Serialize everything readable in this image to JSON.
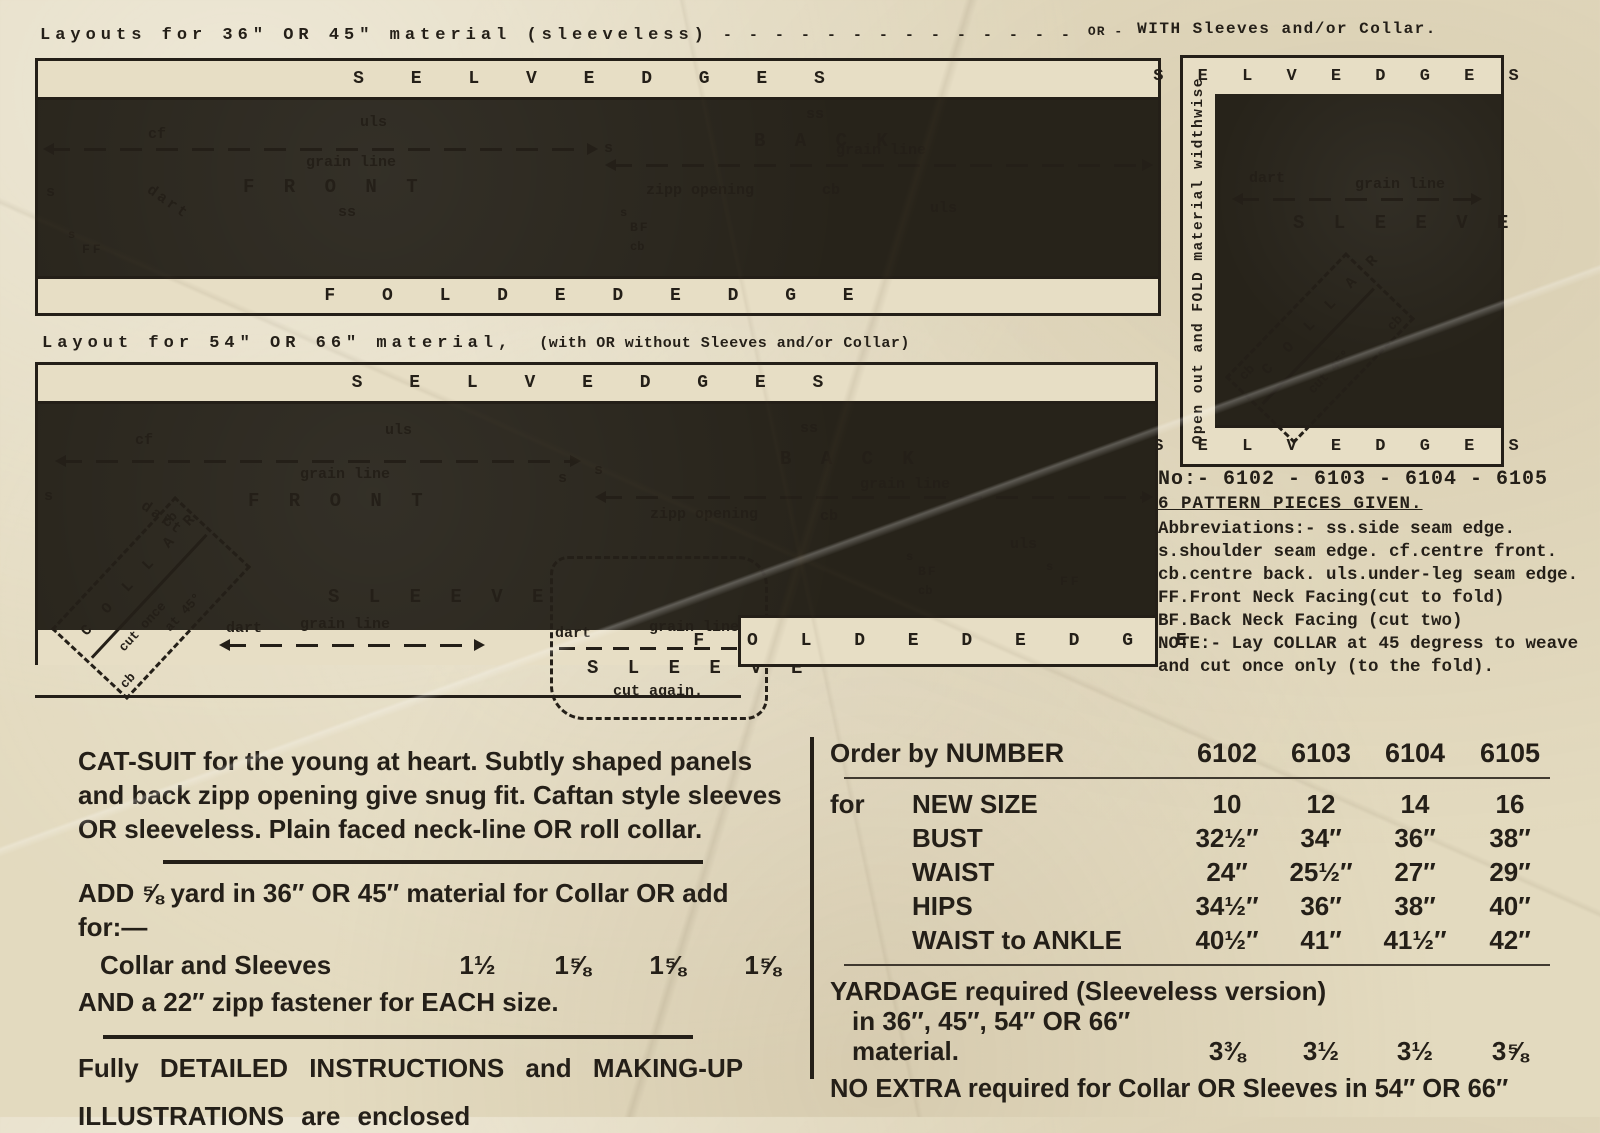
{
  "colors": {
    "paper": "#e7dec5",
    "ink": "#241f18",
    "fabric_dark": "#27231a",
    "accent": "#241f18"
  },
  "header": {
    "layout1_title": "Layouts for 36″ OR 45″ material (sleeveless)",
    "dashes": "- - - - - - - - - - - - - -",
    "or_label": "OR -",
    "with_label": "WITH Sleeves and/or Collar.",
    "layout2_title": "Layout for 54″ OR 66″ material,",
    "layout2_subtitle": "(with OR without Sleeves and/or Collar)"
  },
  "strips": {
    "selvedges": "S E L V E D G E S",
    "folded_edge": "F O L D E D   E D G E"
  },
  "panel": {
    "vertical_text": "Open out and FOLD material widthwise"
  },
  "pieces": {
    "front": "F R O N T",
    "back": "B A C K",
    "sleeve": "S L E E V E",
    "collar": "C O L L A R",
    "cut45": "cut 45°",
    "cut_once": "cut once",
    "at45": "at 45°",
    "cut_again": "cut again."
  },
  "abbr": {
    "s": "s",
    "ss": "ss",
    "cf": "cf",
    "cb": "cb",
    "uls": "uls",
    "dart": "dart",
    "ff": "FF",
    "bf": "BF",
    "grain": "grain  line",
    "zipp": "zipp opening"
  },
  "info": {
    "no_line": "No:- 6102 - 6103 - 6104 - 6105",
    "pieces_line": "6 PATTERN PIECES GIVEN.",
    "lines": [
      "Abbreviations:-  ss.side seam edge.",
      "s.shoulder seam edge. cf.centre front.",
      "cb.centre back.  uls.under-leg seam edge.",
      "FF.Front Neck Facing(cut to fold)",
      "BF.Back Neck Facing (cut two)",
      "NOTE:- Lay COLLAR at 45 degress to weave",
      "and cut once only (to the fold)."
    ]
  },
  "left": {
    "para_l1": "CAT-SUIT for the young at heart.  Subtly shaped panels",
    "para_l2": "and back zipp opening give snug fit.  Caftan style sleeves",
    "para_l3": "OR sleeveless.  Plain faced neck-line OR roll collar.",
    "add_l1": "ADD ⅝ yard in 36″ OR 45″ material for Collar OR add",
    "add_l2": "for:—",
    "collar_sleeves_label": "Collar and Sleeves",
    "collar_sleeves_values": [
      "1½",
      "1⅝",
      "1⅝",
      "1⅝"
    ],
    "zipp_line": "AND a 22″ zipp fastener for EACH size.",
    "instr_l1": "Fully DETAILED INSTRUCTIONS and MAKING-UP",
    "instr_l2": "ILLUSTRATIONS are enclosed"
  },
  "order": {
    "order_by": "Order by",
    "number": "NUMBER",
    "numbers": [
      "6102",
      "6103",
      "6104",
      "6105"
    ],
    "for_label": "for",
    "rows": [
      {
        "label": "NEW SIZE",
        "values": [
          "10",
          "12",
          "14",
          "16"
        ]
      },
      {
        "label": "BUST",
        "values": [
          "32½″",
          "34″",
          "36″",
          "38″"
        ]
      },
      {
        "label": "WAIST",
        "values": [
          "24″",
          "25½″",
          "27″",
          "29″"
        ]
      },
      {
        "label": "HIPS",
        "values": [
          "34½″",
          "36″",
          "38″",
          "40″"
        ]
      },
      {
        "label": "WAIST to ANKLE",
        "values": [
          "40½″",
          "41″",
          "41½″",
          "42″"
        ]
      }
    ],
    "yardage_l1": "YARDAGE required (Sleeveless version)",
    "yardage_l2": "in 36″, 45″, 54″ OR 66″",
    "yardage_l3": "material.",
    "yardage_values": [
      "3⅜",
      "3½",
      "3½",
      "3⅝"
    ],
    "no_extra": "NO EXTRA required for Collar OR Sleeves in 54″ OR 66″"
  }
}
